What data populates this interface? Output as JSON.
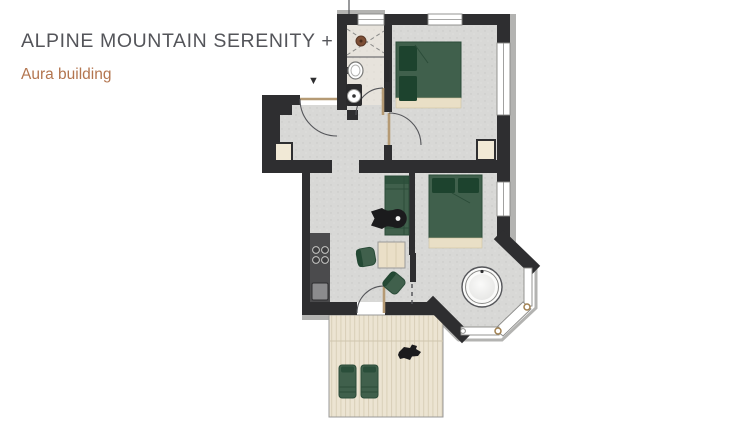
{
  "header": {
    "title": "ALPINE MOUNTAIN SERENITY +",
    "subtitle": "Aura building"
  },
  "floorplan": {
    "entrance_marker": "▼",
    "icons": [
      "entrance-marker-icon",
      "shower-icon",
      "sink-icon",
      "toilet-icon",
      "stove-icon",
      "hot-tub-icon",
      "double-bed-icon",
      "sofa-icon",
      "dining-table-icon",
      "lounger-icon"
    ]
  },
  "colors": {
    "wall": "#2e2e30",
    "floor": "#d8d8d6",
    "bath_floor": "#e7e3dc",
    "green": "#40604c",
    "green_dark": "#1d432e",
    "green_stroke": "#2b4c39",
    "beige": "#e9dfc6",
    "wood": "#eadfc7",
    "terrace": "#ece4d2",
    "terrace_line": "#d9cfb8",
    "counter": "#4b4b4d",
    "ext": "#b3b3b1",
    "line": "#55565a",
    "brass": "#a08050",
    "door": "#b59a74",
    "title": "#54555a",
    "subtitle": "#b3754f",
    "blob": "#1b1b1d"
  }
}
